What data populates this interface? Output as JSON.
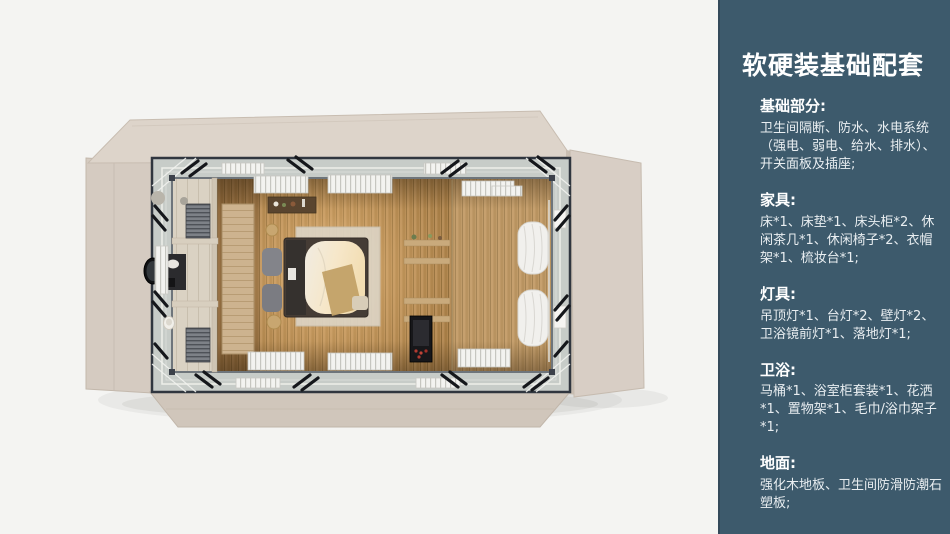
{
  "colors": {
    "panel_bg": "#3d5a6c",
    "panel_border": "#33495a",
    "heading_text": "#ffffff",
    "body_text": "#e9eef1",
    "canvas_bg": "#f4f4f2"
  },
  "panel": {
    "title": "软硬装基础配套",
    "sections": [
      {
        "heading": "基础部分:",
        "body": "卫生间隔断、防水、水电系统（强电、弱电、给水、排水）、开关面板及插座;"
      },
      {
        "heading": "家具:",
        "body": "床*1、床垫*1、床头柜*2、休闲茶几*1、休闲椅子*2、衣帽架*1、梳妆台*1;"
      },
      {
        "heading": "灯具:",
        "body": "吊顶灯*1、台灯*2、壁灯*2、卫浴镜前灯*1、落地灯*1;"
      },
      {
        "heading": "卫浴:",
        "body": "马桶*1、浴室柜套装*1、花洒*1、置物架*1、毛巾/浴巾架子*1;"
      },
      {
        "heading": "地面:",
        "body": "强化木地板、卫生间防滑防潮石塑板;"
      }
    ]
  }
}
